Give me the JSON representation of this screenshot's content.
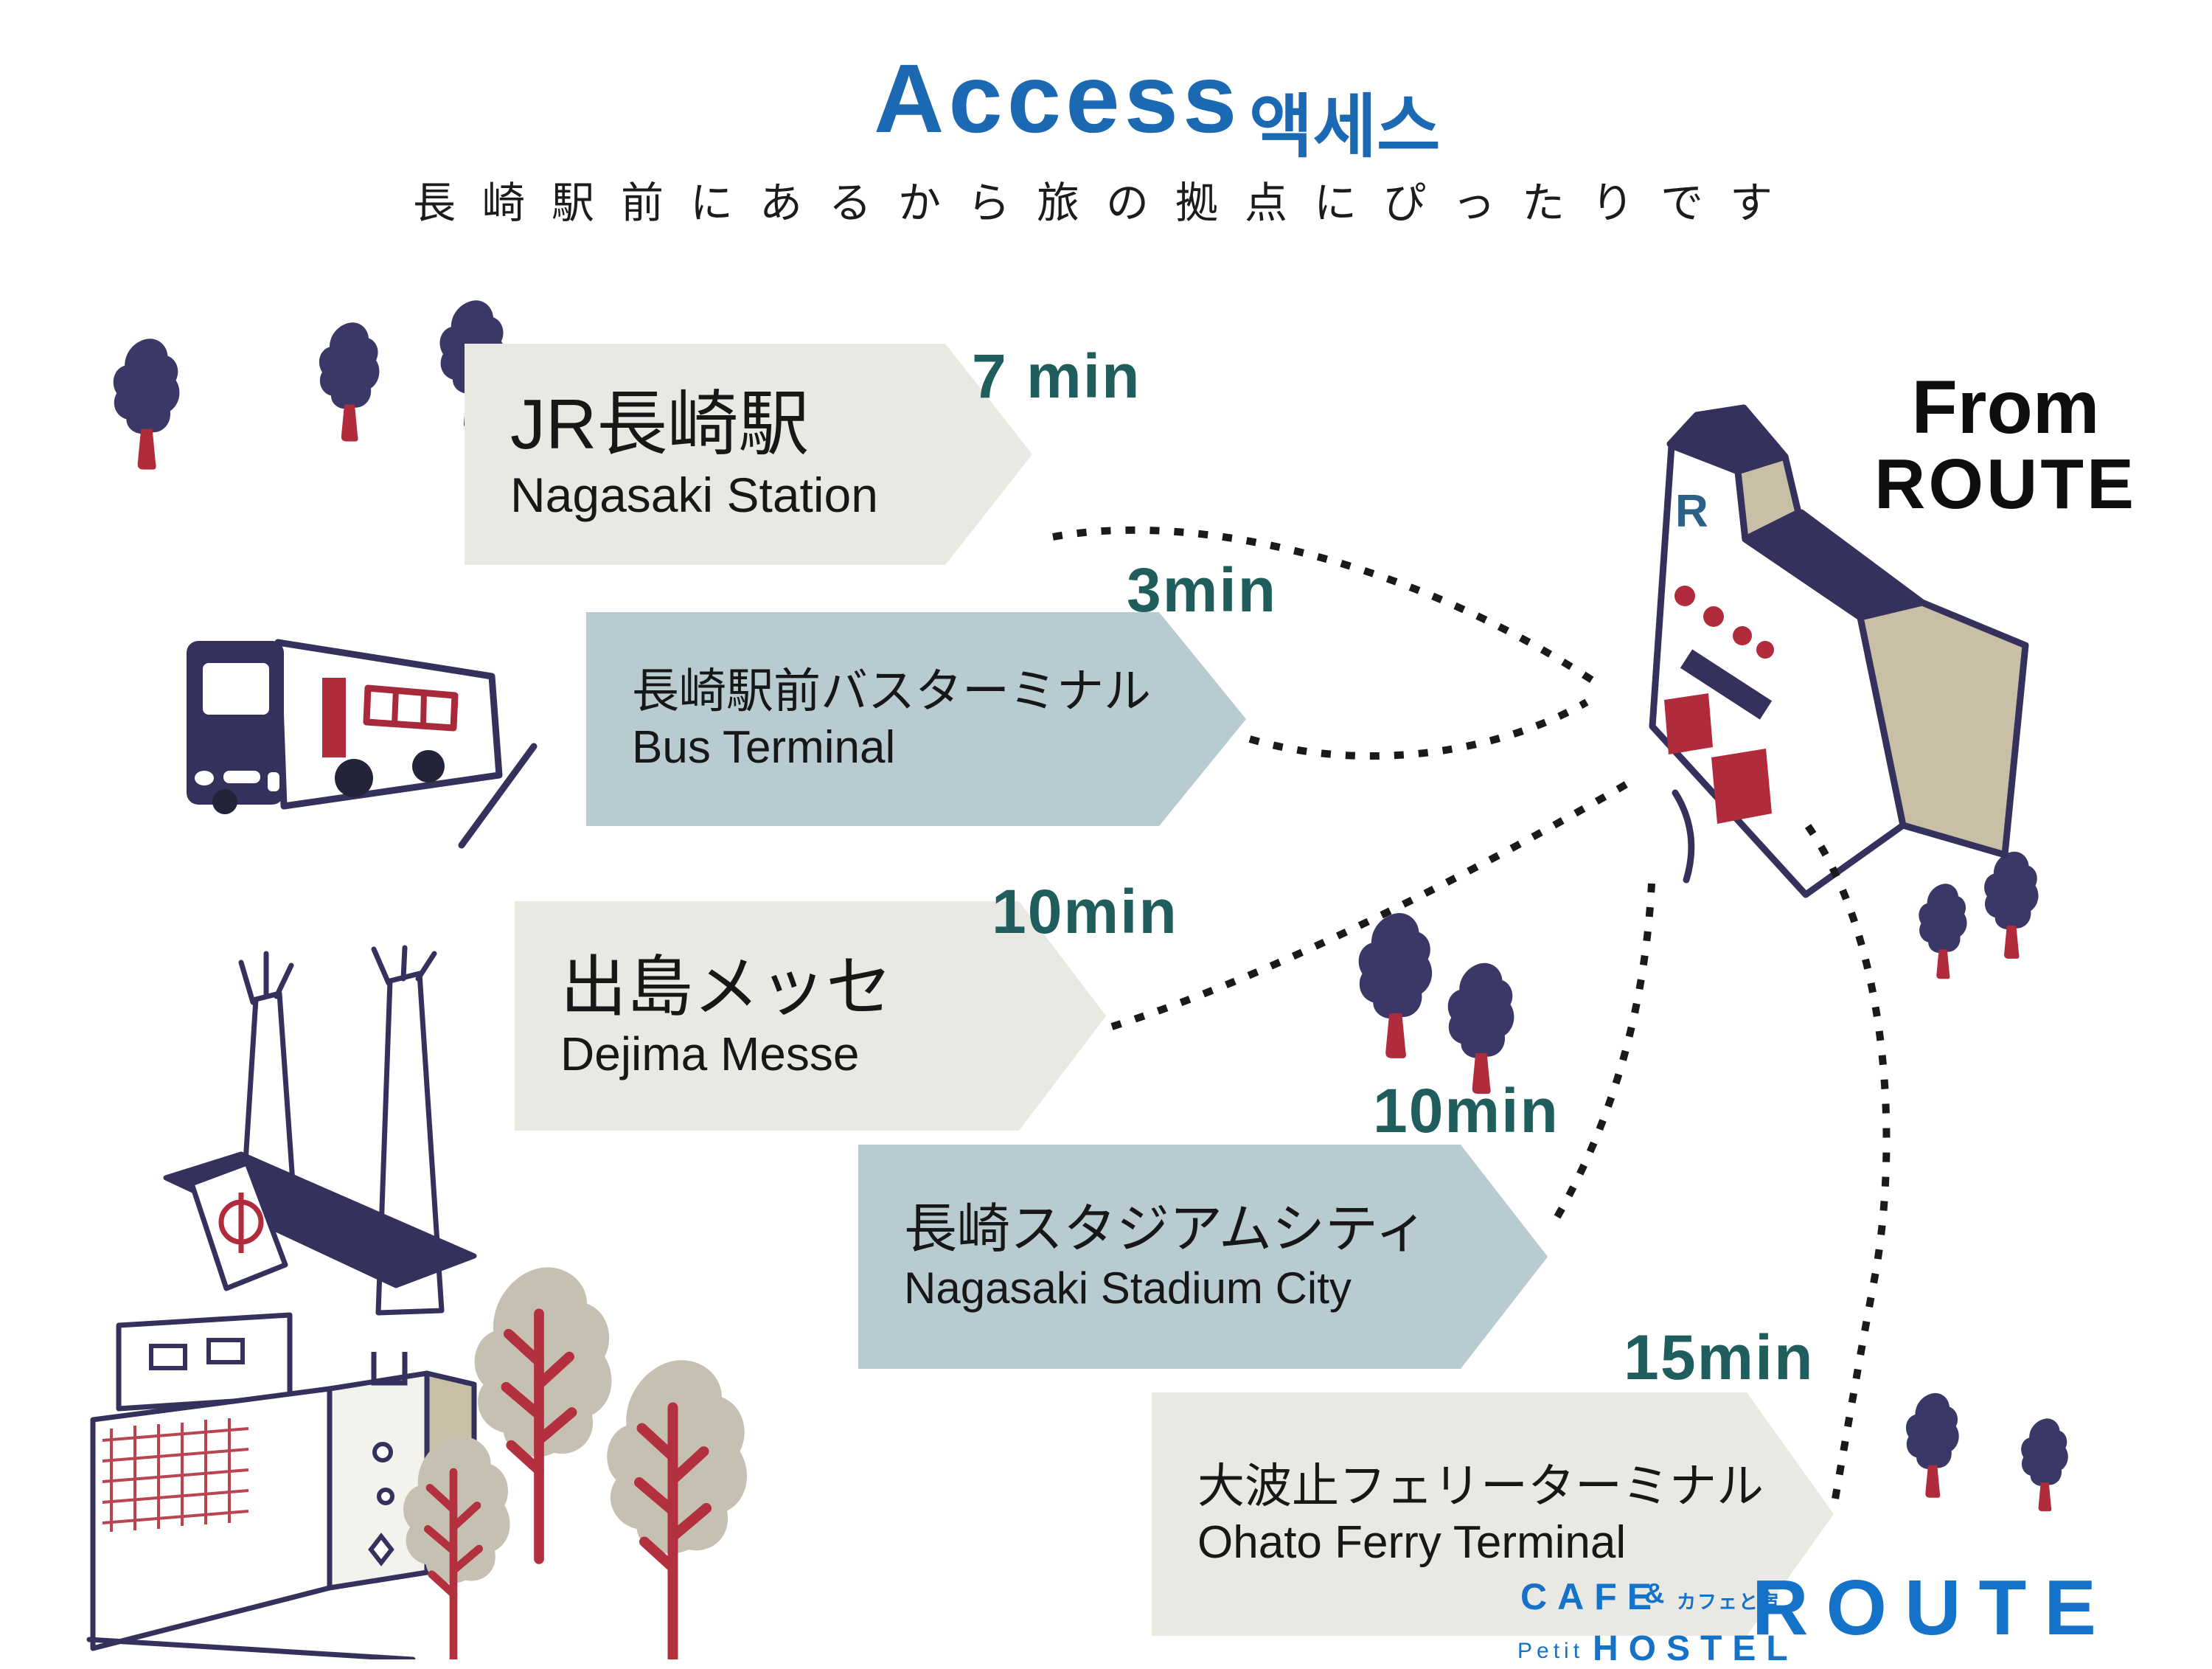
{
  "title": {
    "en": "Access",
    "ko": "액세스"
  },
  "subtitle": "長崎駅前にあるから旅の拠点にぴったりです",
  "origin": {
    "from": "From",
    "name": "ROUTE",
    "building_letter": "R"
  },
  "destinations": [
    {
      "jp": "JR長崎駅",
      "en": "Nagasaki Station",
      "time": "7 min"
    },
    {
      "jp": "長崎駅前バスターミナル",
      "en": "Bus Terminal",
      "time": "3min"
    },
    {
      "jp": "出島メッセ",
      "en": "Dejima Messe",
      "time": "10min"
    },
    {
      "jp": "長崎スタジアムシティ",
      "en": "Nagasaki Stadium City",
      "time": "10min"
    },
    {
      "jp": "大波止フェリーターミナル",
      "en": "Ohato Ferry Terminal",
      "time": "15min"
    }
  ],
  "logo": {
    "cafe": "CAFE",
    "ampersand": "&",
    "amp_note": "カフェと宿",
    "petit": "Petit",
    "hostel": "HOSTEL",
    "brand": "ROUTE"
  },
  "colors": {
    "title_blue": "#1b69b2",
    "time_teal": "#1f5e5c",
    "arrow_gray": "#e9e8e3",
    "arrow_blue": "#b7cbd1",
    "illustration_navy": "#3a3866",
    "illustration_red": "#b02c3c",
    "roof_tan": "#c9bfa6",
    "tree_gray": "#c6c0b3",
    "logo_blue": "#1472c8",
    "text_dark": "#171717"
  }
}
